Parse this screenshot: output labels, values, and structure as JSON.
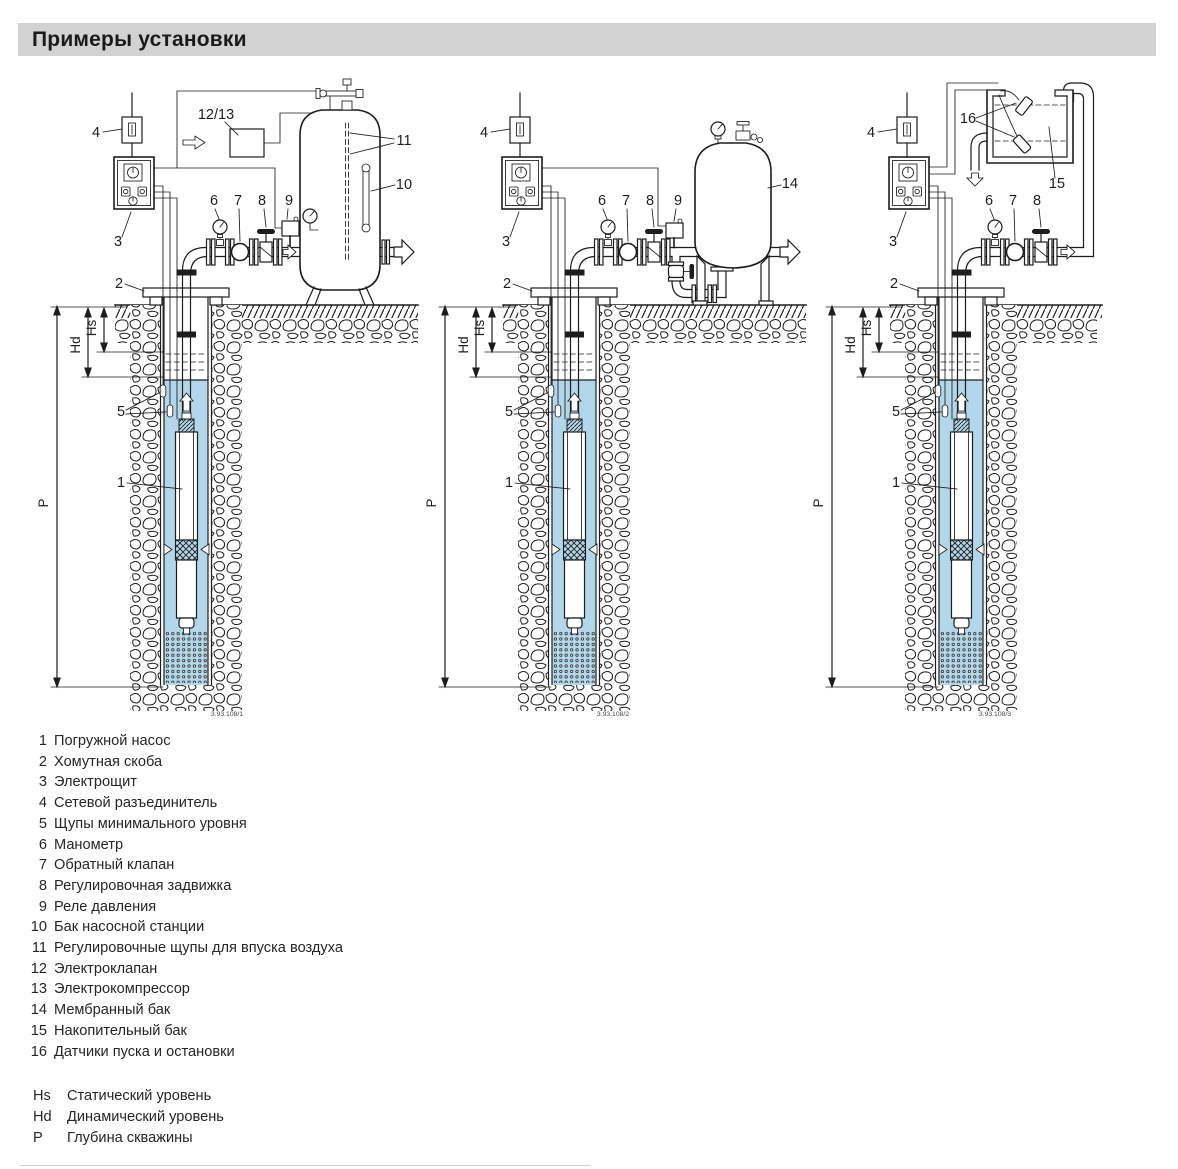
{
  "title": "Примеры установки",
  "colors": {
    "title_bar_bg": "#d2d2d2",
    "line": "#1d1d1d",
    "water": "#b3d7ea"
  },
  "callouts": {
    "c1": "1",
    "c2": "2",
    "c3": "3",
    "c4": "4",
    "c5": "5",
    "c6": "6",
    "c7": "7",
    "c8": "8",
    "c9": "9",
    "c10": "10",
    "c11": "11",
    "c12_13": "12/13",
    "c14": "14",
    "c15": "15",
    "c16": "16"
  },
  "levels": {
    "hs": "Hs",
    "hd": "Hd",
    "p": "P"
  },
  "diagrams": [
    {
      "name": "pump-station-tank-installation",
      "figure_number": "3.93.108/1"
    },
    {
      "name": "membrane-tank-installation",
      "figure_number": "3.93.108/2"
    },
    {
      "name": "storage-tank-installation",
      "figure_number": "3.93.108/3"
    }
  ],
  "legend": {
    "items": [
      {
        "num": "1",
        "text": "Погружной насос"
      },
      {
        "num": "2",
        "text": "Хомутная скоба"
      },
      {
        "num": "3",
        "text": "Электрощит"
      },
      {
        "num": "4",
        "text": "Сетевой разъединитель"
      },
      {
        "num": "5",
        "text": "Щупы минимального уровня"
      },
      {
        "num": "6",
        "text": "Манометр"
      },
      {
        "num": "7",
        "text": "Обратный клапан"
      },
      {
        "num": "8",
        "text": "Регулировочная задвижка"
      },
      {
        "num": "9",
        "text": "Реле давления"
      },
      {
        "num": "10",
        "text": "Бак насосной станции"
      },
      {
        "num": "11",
        "text": "Регулировочные щупы для впуска воздуха"
      },
      {
        "num": "12",
        "text": "Электроклапан"
      },
      {
        "num": "13",
        "text": "Электрокомпрессор"
      },
      {
        "num": "14",
        "text": "Мембранный бак"
      },
      {
        "num": "15",
        "text": "Накопительный бак"
      },
      {
        "num": "16",
        "text": "Датчики пуска и остановки"
      }
    ],
    "level_items": [
      {
        "num": "Hs",
        "text": "Статический уровень"
      },
      {
        "num": "Hd",
        "text": "Динамический уровень"
      },
      {
        "num": "P",
        "text": "Глубина скважины"
      }
    ]
  }
}
